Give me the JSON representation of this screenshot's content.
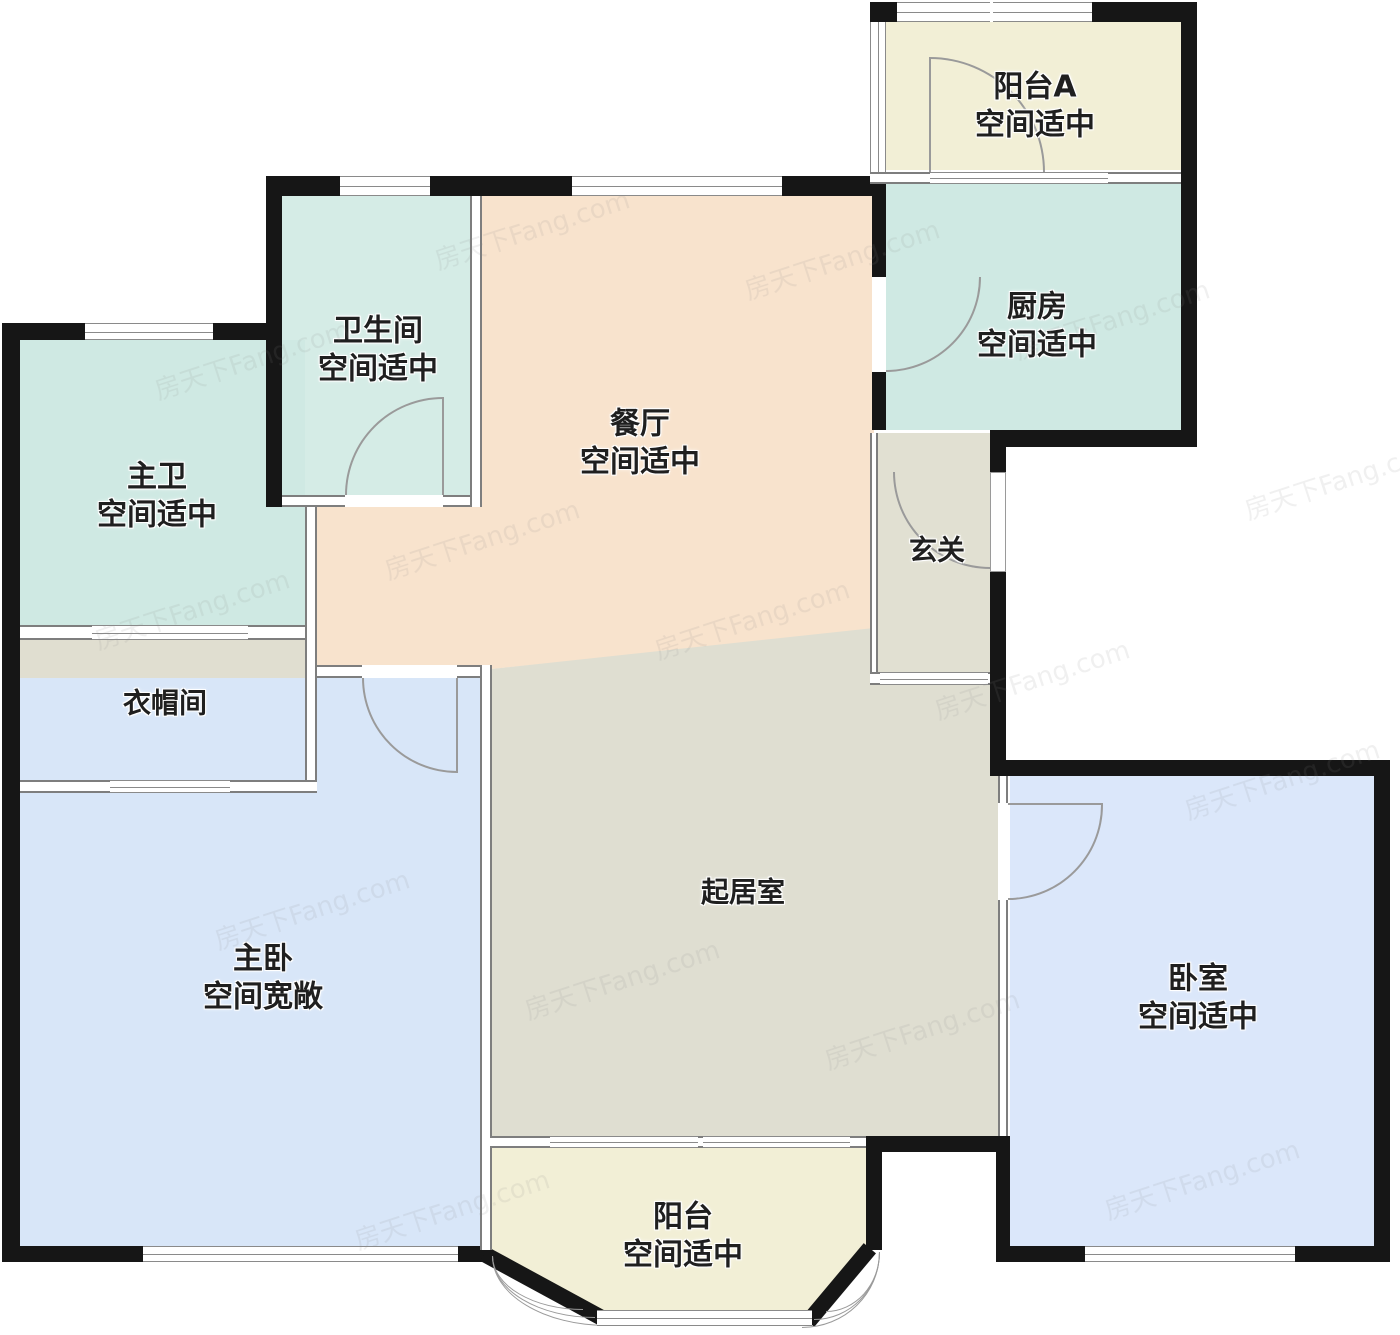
{
  "watermark": {
    "text": "房天下Fang.com"
  },
  "colors": {
    "exterior_wall": "#161616",
    "interior_wall": "#7e7e7e",
    "window_line": "#8a8a8a",
    "door_arc": "#9a9a9a",
    "label_text": "#1f1f1f",
    "background": "#ffffff"
  },
  "rooms": [
    {
      "id": "balcony-a",
      "name": "阳台A",
      "note": "空间适中",
      "color": "#f2efd6"
    },
    {
      "id": "kitchen",
      "name": "厨房",
      "note": "空间适中",
      "color": "#cfe9e3"
    },
    {
      "id": "bathroom",
      "name": "卫生间",
      "note": "空间适中",
      "color": "#d5ece6"
    },
    {
      "id": "master-bath",
      "name": "主卫",
      "note": "空间适中",
      "color": "#cfe9e3"
    },
    {
      "id": "dining",
      "name": "餐厅",
      "note": "空间适中",
      "color": "#f8e3cd"
    },
    {
      "id": "entry",
      "name": "玄关",
      "note": "",
      "color": "#e1e0d2"
    },
    {
      "id": "cloakroom",
      "name": "衣帽间",
      "note": "",
      "color": "#e0ded0"
    },
    {
      "id": "living",
      "name": "起居室",
      "note": "",
      "color": "#dfded1"
    },
    {
      "id": "master-bedroom",
      "name": "主卧",
      "note": "空间宽敞",
      "color": "#d8e6f8"
    },
    {
      "id": "bedroom",
      "name": "卧室",
      "note": "空间适中",
      "color": "#dbe7fa"
    },
    {
      "id": "balcony",
      "name": "阳台",
      "note": "空间适中",
      "color": "#f2efd6"
    }
  ]
}
